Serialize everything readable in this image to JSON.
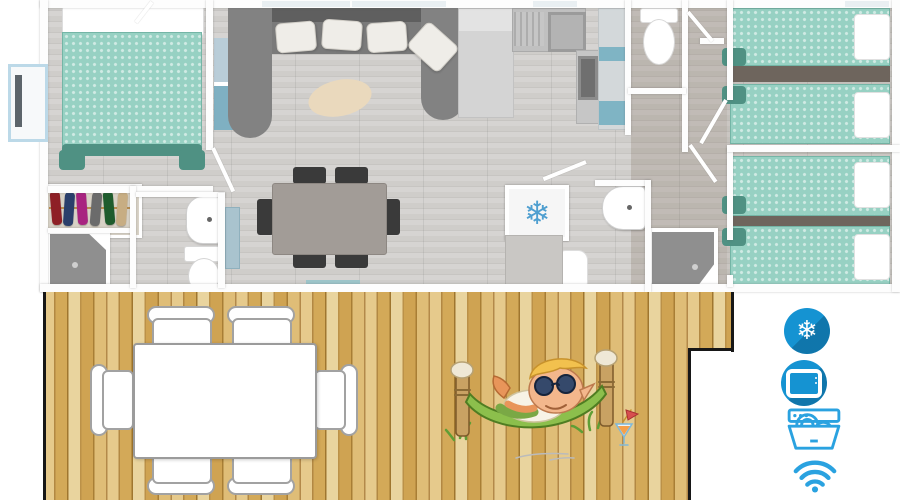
{
  "image": {
    "kind": "3d-top-view-floor-plan-with-terrace",
    "width": 900,
    "height": 500
  },
  "amenities": {
    "accent_color": "#1593d2",
    "outline_color": "#2aa2e0",
    "items": [
      {
        "id": "air-conditioning",
        "icon": "snowflake-badge-icon",
        "glyph": "❄",
        "style": "filled-circle"
      },
      {
        "id": "television",
        "icon": "tv-badge-icon",
        "style": "filled-circle"
      },
      {
        "id": "dishwasher",
        "icon": "dishwasher-icon",
        "style": "outline"
      },
      {
        "id": "wifi",
        "icon": "wifi-icon",
        "style": "outline"
      }
    ]
  },
  "floor_plan": {
    "rooms": [
      "master-bedroom",
      "wardrobe",
      "shower-room",
      "bathroom",
      "living-dining-room",
      "kitchen",
      "wc",
      "second-bathroom",
      "twin-bedroom-1",
      "twin-bedroom-2"
    ],
    "furniture": {
      "double_beds": 1,
      "single_beds": 4,
      "dining_seats": 6,
      "sofa": "u-shaped",
      "fridge_glyph": "❄"
    },
    "colors": {
      "bedding_teal": "#97d1c3",
      "bedding_dark_teal": "#4f9183",
      "floor_wood": "#d0cecb",
      "wall": "#ffffff",
      "sofa_gray": "#7e7e7e",
      "deck_wood": "#d4ab60",
      "fridge_snowflake_blue": "#4f9fd0"
    }
  },
  "deck": {
    "table_seats": 6,
    "mascot": "elf-relaxing-in-hammock-with-cocktail"
  }
}
